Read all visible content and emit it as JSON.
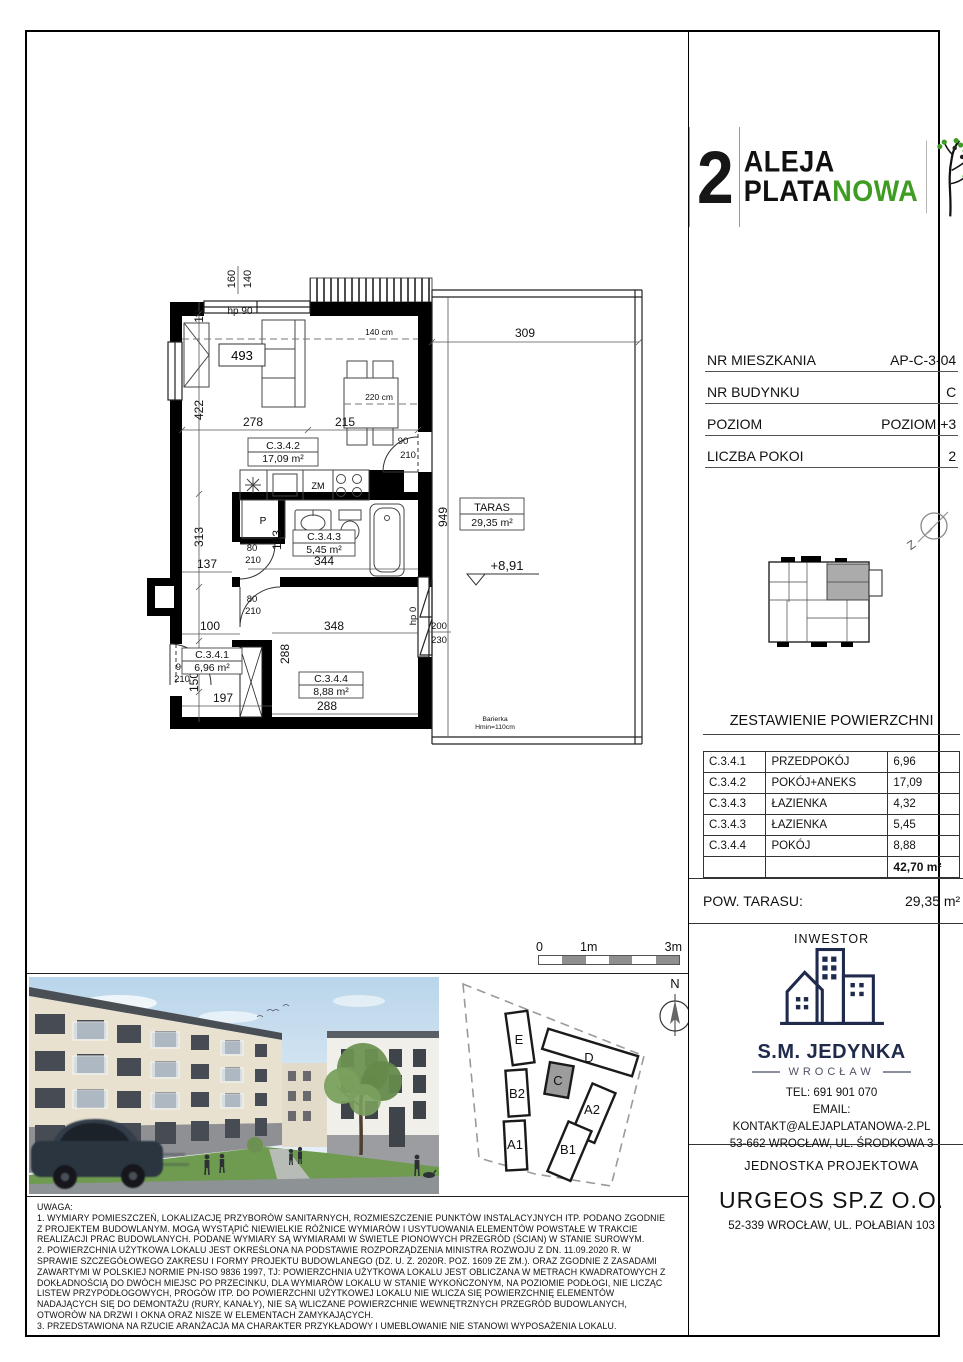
{
  "logo": {
    "number": "2",
    "word1": "ALEJA",
    "word2a": "PLATA",
    "word2b": "NOWA",
    "accent_green": "#3f9c23"
  },
  "unit_info": {
    "rows": [
      {
        "label": "NR MIESZKANIA",
        "value": "AP-C-3-04"
      },
      {
        "label": "NR BUDYNKU",
        "value": "C"
      },
      {
        "label": "POZIOM",
        "value": "POZIOM +3"
      },
      {
        "label": "LICZBA POKOI",
        "value": "2"
      }
    ]
  },
  "key_plan": {
    "compass_label": "Z"
  },
  "area_table": {
    "title": "ZESTAWIENIE POWIERZCHNI",
    "rows": [
      [
        "C.3.4.1",
        "PRZEDPOKÓJ",
        "6,96"
      ],
      [
        "C.3.4.2",
        "POKÓJ+ANEKS",
        "17,09"
      ],
      [
        "C.3.4.3",
        "ŁAZIENKA",
        "4,32"
      ],
      [
        "C.3.4.3",
        "ŁAZIENKA",
        "5,45"
      ],
      [
        "C.3.4.4",
        "POKÓJ",
        "8,88"
      ]
    ],
    "total": "42,70 m²"
  },
  "terrace_row": {
    "label": "POW. TARASU:",
    "value": "29,35 m²"
  },
  "investor": {
    "header": "INWESTOR",
    "name": "S.M. JEDYNKA",
    "city": "WROCŁAW",
    "tel": "TEL: 691 901 070",
    "email_label": "EMAIL:",
    "email": "KONTAKT@ALEJAPLATANOWA-2.PL",
    "address": "53-662 WROCŁAW, UL. ŚRODKOWA 3",
    "logo_color": "#202a4c"
  },
  "designer": {
    "header": "JEDNOSTKA PROJEKTOWA",
    "name": "URGEOS SP.Z O.O.",
    "address": "52-339 WROCŁAW, UL. POŁABIAN 103"
  },
  "plan": {
    "rooms": [
      {
        "code": "C.3.4.1",
        "area": "6,96 m²"
      },
      {
        "code": "C.3.4.2",
        "area": "17,09 m²"
      },
      {
        "code": "C.3.4.3",
        "area": "5,45 m²"
      },
      {
        "code": "C.3.4.4",
        "area": "8,88 m²"
      }
    ],
    "taras": {
      "label": "TARAS",
      "area": "29,35 m²"
    },
    "level": "+8,91",
    "barrier_1": "Barierka",
    "barrier_2": "Hmin=110cm",
    "labels": {
      "zm": "ZM",
      "p": "P"
    },
    "dims": {
      "d18": "18",
      "d160": "160",
      "d140": "140",
      "hp90": "hp 90",
      "d493": "493",
      "d422": "422",
      "d313": "313",
      "d278": "278",
      "d215": "215",
      "d309": "309",
      "d949": "949",
      "ref140": "140 cm",
      "ref220": "220 cm",
      "d90": "90",
      "d210": "210",
      "d80": "80",
      "d137": "137",
      "d163": "163",
      "d344": "344",
      "d100": "100",
      "d150": "150",
      "d197": "197",
      "d288": "288",
      "d348": "348",
      "d200": "200",
      "d230": "230",
      "hp0": "hp 0"
    }
  },
  "scale_bar": {
    "t0": "0",
    "t1": "1m",
    "t3": "3m"
  },
  "site_plan": {
    "north": "N",
    "buildings": [
      "E",
      "D",
      "C",
      "B2",
      "A2",
      "A1",
      "B1"
    ],
    "highlight_color": "#9c9c9c"
  },
  "notes": {
    "title": "UWAGA:",
    "lines": [
      "1. WYMIARY POMIESZCZEŃ, LOKALIZACJĘ PRZYBORÓW SANITARNYCH, ROZMIESZCZENIE PUNKTÓW INSTALACYJNYCH ITP. PODANO ZGODNIE",
      "Z PROJEKTEM BUDOWLANYM. MOGĄ WYSTĄPIĆ NIEWIELKIE RÓŻNICE WYMIARÓW I USYTUOWANIA ELEMENTÓW POWSTAŁE W TRAKCIE",
      "REALIZACJI PRAC BUDOWLANYCH. PODANE WYMIARY SĄ WYMIARAMI W ŚWIETLE PIONOWYCH PRZEGRÓD (ŚCIAN) W STANIE SUROWYM.",
      "2. POWIERZCHNIA UŻYTKOWA LOKALU JEST OKREŚLONA NA PODSTAWIE ROZPORZĄDZENIA MINISTRA ROZWOJU Z DN. 11.09.2020 R. W",
      "SPRAWIE SZCZEGÓŁOWEGO ZAKRESU I FORMY PROJEKTU BUDOWLANEGO (DZ. U. Z. 2020R. POZ. 1609 ZE ZM.). ORAZ ZGODNIE Z ZASADAMI",
      "ZAWARTYMI W POLSKIEJ NORMIE PN-ISO 9836 1997, TJ: POWIERZCHNIA UŻYTKOWA LOKALU JEST OBLICZANA W METRACH KWADRATOWYCH Z",
      "DOKŁADNOŚCIĄ DO DWÓCH MIEJSC PO PRZECINKU, DLA WYMIARÓW LOKALU W STANIE WYKOŃCZONYM, NA POZIOMIE PODŁOGI, NIE LICZĄC",
      "LISTEW PRZYPODŁOGOWYCH, PROGÓW ITP. DO POWIERZCHNI UŻYTKOWEJ LOKALU NIE WLICZA SIĘ POWIERZCHNIĘ ELEMENTÓW",
      "NADAJĄCYCH SIĘ DO DEMONTAŻU (RURY, KANAŁY), NIE SĄ WLICZANE POWIERZCHNIE WEWNĘTRZNYCH PRZEGRÓD BUDOWLANYCH,",
      "OTWORÓW NA DRZWI I OKNA ORAZ NISZE W ELEMENTACH ZAMYKAJĄCYCH.",
      "3. PRZEDSTAWIONA NA RZUCIE ARANŻACJA MA CHARAKTER PRZYKŁADOWY I UMEBLOWANIE NIE STANOWI WYPOSAŻENIA LOKALU."
    ]
  }
}
